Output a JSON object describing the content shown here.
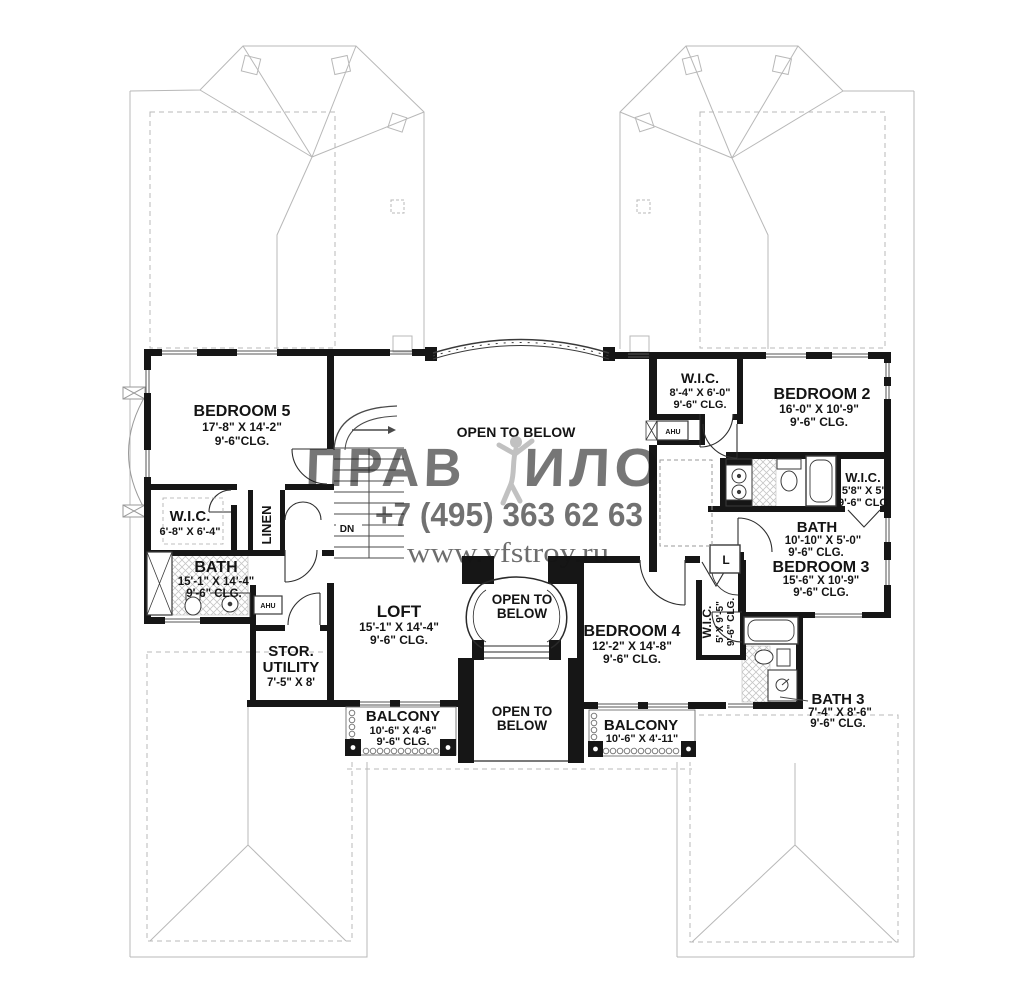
{
  "watermark": {
    "brand_left": "ПРАВ",
    "brand_right": "ИЛО",
    "phone": "+7 (495) 363 62 63",
    "website": "www.vfstroy.ru"
  },
  "rooms": {
    "bedroom5": {
      "name": "BEDROOM 5",
      "dims": "17'-8\" X 14'-2\"",
      "clg": "9'-6\"CLG."
    },
    "wic_bedroom5": {
      "name": "W.I.C.",
      "dims": "6'-8\" X 6'-4\""
    },
    "linen": {
      "name": "LINEN"
    },
    "bath_master": {
      "name": "BATH",
      "dims": "15'-1\" X 14'-4\"",
      "clg": "9'-6\" CLG."
    },
    "stor_utility": {
      "name_line1": "STOR.",
      "name_line2": "UTILITY",
      "dims": "7'-5\" X 8'"
    },
    "loft": {
      "name": "LOFT",
      "dims": "15'-1\" X 14'-4\"",
      "clg": "9'-6\" CLG."
    },
    "open_to_below_top": {
      "name": "OPEN TO BELOW"
    },
    "open_to_below_mid": {
      "line1": "OPEN TO",
      "line2": "BELOW"
    },
    "open_to_below_bottom": {
      "line1": "OPEN TO",
      "line2": "BELOW"
    },
    "bedroom4": {
      "name": "BEDROOM 4",
      "dims": "12'-2\" X 14'-8\"",
      "clg": "9'-6\" CLG."
    },
    "wic_bedroom4": {
      "name": "W.I.C.",
      "dims": "5' X 9'-5\"",
      "clg": "9'-6\" CLG."
    },
    "wic_bedroom2": {
      "name": "W.I.C.",
      "dims": "8'-4\" X 6'-0\"",
      "clg": "9'-6\" CLG."
    },
    "bedroom2": {
      "name": "BEDROOM 2",
      "dims": "16'-0\" X 10'-9\"",
      "clg": "9'-6\" CLG."
    },
    "wic_bath2": {
      "name": "W.I.C.",
      "dims": "5'8\" X 5'",
      "clg": "9'-6\" CLG"
    },
    "bath2": {
      "name": "BATH",
      "dims": "10'-10\" X 5'-0\"",
      "clg": "9'-6\" CLG."
    },
    "bedroom3": {
      "name": "BEDROOM 3",
      "dims": "15'-6\" X 10'-9\"",
      "clg": "9'-6\" CLG."
    },
    "bath3": {
      "name": "BATH 3",
      "dims": "7'-4\" X 8'-6\"",
      "clg": "9'-6\" CLG."
    },
    "balcony_left": {
      "name": "BALCONY",
      "dims": "10'-6\" X 4'-6\"",
      "clg": "9'-6\" CLG."
    },
    "balcony_right": {
      "name": "BALCONY",
      "dims": "10'-6\" X 4'-11\""
    }
  },
  "annotations": {
    "down": "DN",
    "ahu_left": "AHU",
    "ahu_right": "AHU",
    "linen_closet_small": "L"
  }
}
